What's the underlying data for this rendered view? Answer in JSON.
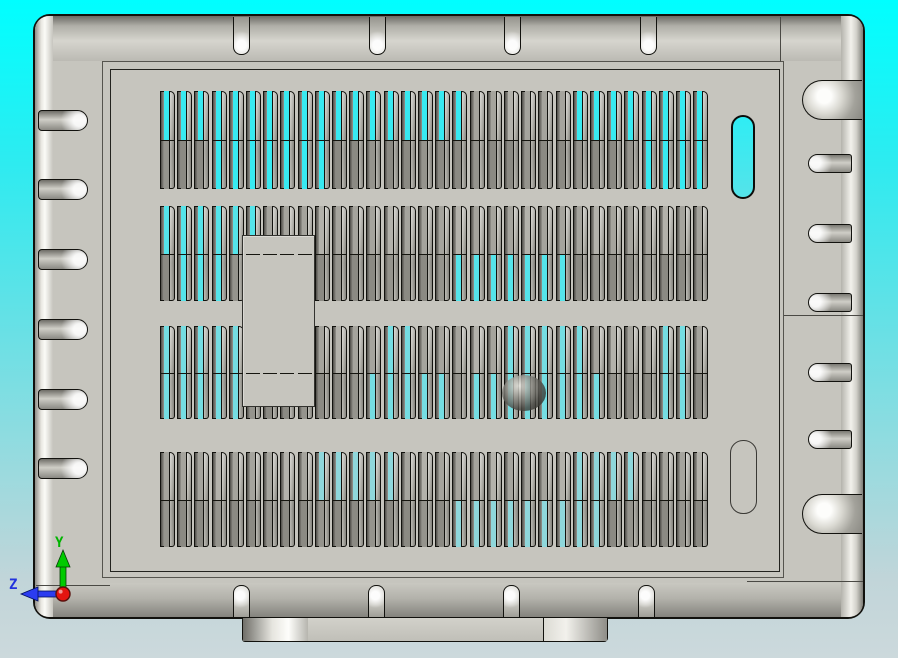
{
  "scene": {
    "description": "CAD viewport showing vented sheet-metal enclosure, top view",
    "background": {
      "top": "#00FFFF",
      "bottom": "#CCD9DC"
    }
  },
  "triad": {
    "label_y": "Y",
    "label_z": "Z",
    "axis_y_color": "#00C800",
    "axis_z_color": "#2438E8",
    "origin_color": "#E81410"
  },
  "colors": {
    "body_gray": "#C6C5BE",
    "outline": "#12120E",
    "vent_open_cyan": "#3BEAF1"
  },
  "enclosure": {
    "x": 33,
    "y": 14,
    "w": 832,
    "h": 605,
    "corner_radius": 17,
    "panel": {
      "x": 108,
      "y": 67,
      "w": 670,
      "h": 503
    },
    "right_divider_y": 313,
    "lines": [
      {
        "x": 34,
        "y": 583,
        "w": 74,
        "h": 1
      },
      {
        "x": 745,
        "y": 579,
        "w": 118,
        "h": 1
      },
      {
        "x": 778,
        "y": 15,
        "w": 1,
        "h": 45
      }
    ],
    "top_tabs": {
      "xs": [
        231,
        367,
        502,
        638
      ],
      "y": 15,
      "w": 17,
      "h": 38
    },
    "bottom_tabs": {
      "xs": [
        231,
        366,
        501,
        636
      ],
      "y": 583,
      "w": 17,
      "h": 35
    },
    "left_tabs": {
      "ys": [
        108,
        177,
        247,
        317,
        387,
        456
      ],
      "x": 36,
      "w": 50,
      "h": 21
    },
    "right_tabs": {
      "ys": [
        152,
        222,
        291,
        361,
        428
      ],
      "x": 806,
      "w": 44,
      "h": 19
    },
    "right_bumps": {
      "ys": [
        78,
        492
      ],
      "x": 800,
      "w": 60,
      "h": 40
    },
    "cutout_slot": {
      "x": 729,
      "y": 113,
      "w": 24,
      "h": 84
    },
    "blind_slot": {
      "x": 728,
      "y": 438,
      "w": 27,
      "h": 74
    },
    "patch": {
      "x": 240,
      "y": 233,
      "w": 73,
      "h": 172
    },
    "sphere": {
      "x": 500,
      "y": 373,
      "w": 44,
      "h": 36
    },
    "foot": {
      "x": 242,
      "y": 618,
      "w": 366,
      "h": 24,
      "seg1": 65,
      "seg2": 300
    }
  },
  "vents": {
    "x0": 158,
    "pitch": 17.2,
    "cols": 32,
    "cell_w": 15,
    "gray_top": "#A5A49D",
    "gray_bottom": "#8B8A83",
    "rows": [
      {
        "y": 89,
        "h": 98,
        "cyan": "#38EAF1",
        "cyan_top": [
          0,
          1,
          2,
          3,
          4,
          5,
          6,
          7,
          8,
          9,
          10,
          11,
          12,
          13,
          14,
          15,
          16,
          17,
          24,
          25,
          26,
          27,
          28,
          29,
          30,
          31
        ],
        "cyan_bottom": [
          3,
          4,
          5,
          6,
          7,
          8,
          9,
          28,
          29,
          30,
          31
        ]
      },
      {
        "y": 204,
        "h": 95,
        "cyan": "#55E4EA",
        "cyan_top": [
          0,
          1,
          2,
          3,
          4,
          5
        ],
        "cyan_bottom": [
          1,
          2,
          3,
          17,
          18,
          19,
          20,
          21,
          22,
          23
        ]
      },
      {
        "y": 324,
        "h": 93,
        "cyan": "#75DDE2",
        "cyan_top": [
          0,
          1,
          2,
          3,
          4,
          13,
          14,
          20,
          21,
          22,
          23,
          24,
          29,
          30
        ],
        "cyan_bottom": [
          0,
          1,
          2,
          3,
          4,
          12,
          13,
          14,
          15,
          16,
          18,
          19,
          20,
          21,
          22,
          23,
          24,
          25,
          29,
          30
        ]
      },
      {
        "y": 450,
        "h": 95,
        "cyan": "#8FD7DB",
        "cyan_top": [
          9,
          10,
          11,
          12,
          13,
          24,
          25,
          26,
          27
        ],
        "cyan_bottom": [
          17,
          18,
          19,
          20,
          21,
          22,
          23,
          24,
          25
        ]
      }
    ]
  }
}
